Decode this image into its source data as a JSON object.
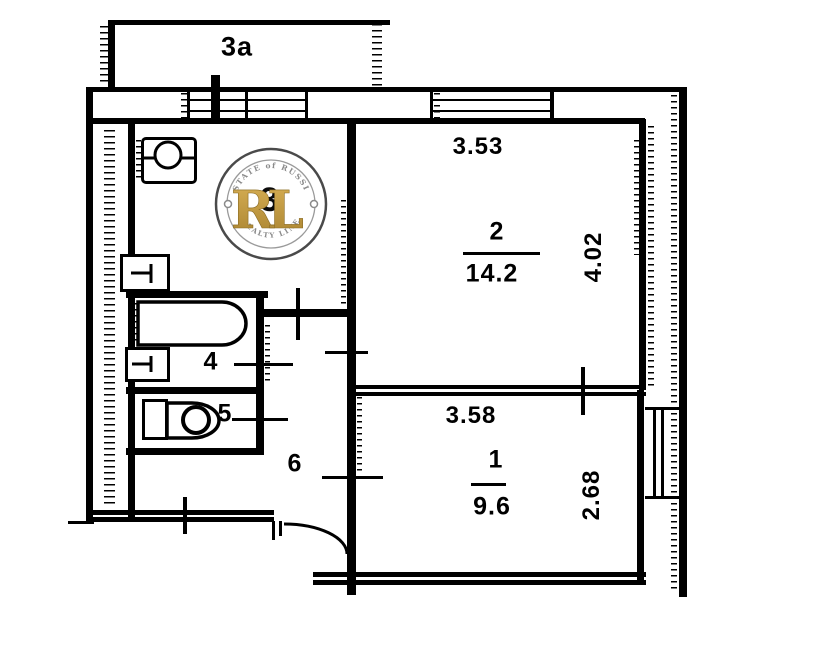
{
  "balcony": {
    "label": "3a"
  },
  "kitchen": {
    "number": "3"
  },
  "room2": {
    "number": "2",
    "area": "14.2",
    "width_dim": "3.53",
    "depth_dim": "4.02"
  },
  "room1": {
    "number": "1",
    "area": "9.6",
    "width_dim": "3.58",
    "depth_dim": "2.68"
  },
  "bathroom": {
    "number": "4"
  },
  "toilet": {
    "number": "5"
  },
  "hallway": {
    "number": "6"
  },
  "watermark": {
    "arc_top": "ESTATE of RUSSIA",
    "monogram": "RL",
    "arc_bottom": "REALTY LINE",
    "gold_light": "#D8B055",
    "gold_dark": "#A8822F",
    "ring_color": "#4a4a4a"
  },
  "colors": {
    "wall": "#000000",
    "background": "#ffffff"
  }
}
